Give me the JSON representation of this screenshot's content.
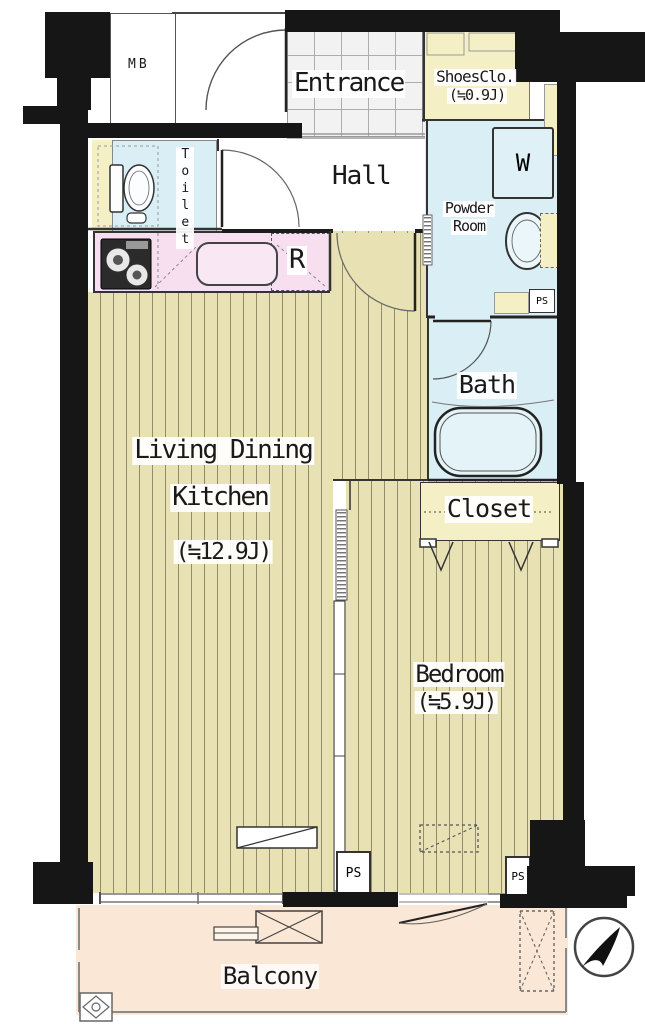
{
  "labels": {
    "mb": "MB",
    "entrance": "Entrance",
    "shoes_closet": "ShoesClo.",
    "shoes_closet_size": "(≒0.9J)",
    "hall": "Hall",
    "toilet": "Toilet",
    "washer": "W",
    "powder_room_line1": "Powder",
    "powder_room_line2": "Room",
    "refrigerator": "R",
    "bath": "Bath",
    "closet": "Closet",
    "ldk_line1": "Living Dining",
    "ldk_line2": "Kitchen",
    "ldk_size": "(≒12.9J)",
    "bedroom": "Bedroom",
    "bedroom_size": "(≒5.9J)",
    "balcony": "Balcony",
    "pipe_space": "PS"
  },
  "colors": {
    "wall": "#161616",
    "wood_floor": "#e8e1b3",
    "wood_stripe": "#938b69",
    "wet_area_blue": "#d9eef5",
    "kitchen_pink": "#f7dff0",
    "closet_cream": "#f5efc6",
    "balcony_peach": "#fbe7d5",
    "entrance_tile": "#f2f2f2"
  }
}
